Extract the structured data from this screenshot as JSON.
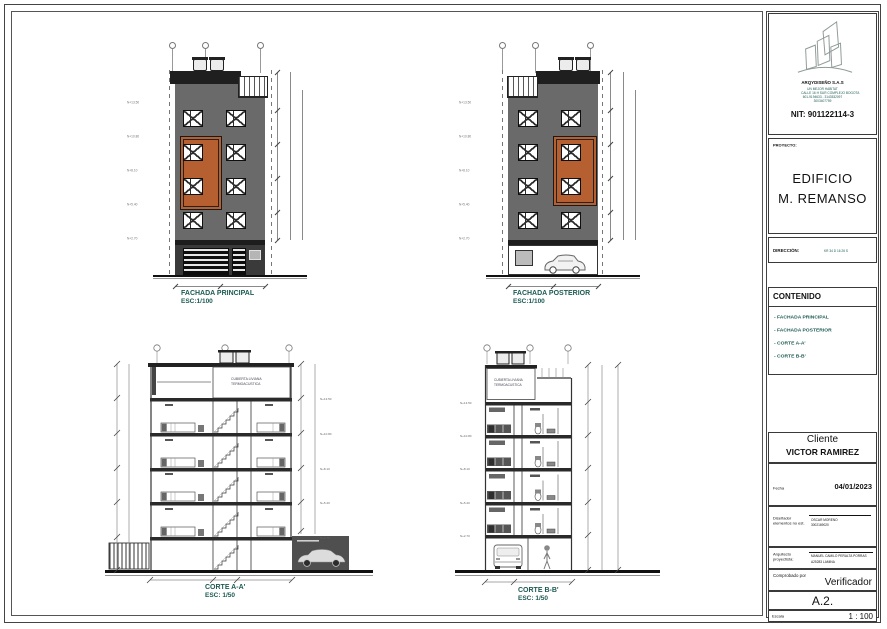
{
  "colors": {
    "facade_gray": "#6a6a6a",
    "facade_dark": "#1f1f1f",
    "accent_orange": "#b65f30",
    "label_teal": "#1c5a52"
  },
  "title_block": {
    "company_name": "ARQYDISEÑO S.A.S",
    "company_line1": "UN MEJOR HABITAT",
    "company_line2": "CALLE 16 H SUR COMPLEJO BOGOTA",
    "company_line3": "601-9194633 - 3143532097",
    "company_line4": "3003407759",
    "nit": "NIT: 901122114-3",
    "proyecto_label": "PROYECTO:",
    "proyecto_line1": "EDIFICIO",
    "proyecto_line2": "M. REMANSO",
    "direccion_label": "DIRECCIÓN:",
    "direccion_value": "KR 34 D 16 26 S",
    "contenido_title": "CONTENIDO",
    "contenido_items": [
      "- FACHADA PRINCIPAL",
      "- FACHADA POSTERIOR",
      "- CORTE A-A'",
      "- CORTE B-B'"
    ],
    "cliente_label": "Cliente",
    "cliente_name": "VICTOR RAMIREZ",
    "fecha_label": "Fecha",
    "fecha_value": "04/01/2023",
    "disenador_label_line1": "Diseñador",
    "disenador_label_line2": "elementos no est.",
    "disenador_value_line1": "OSCAR MORENO",
    "disenador_value_line2": "3002169020",
    "arquitecto_label_line1": "Arquitecto",
    "arquitecto_label_line2": "proyectista:",
    "arquitecto_value_line1": "MANUEL CAMILO PERALTA PORRAS",
    "arquitecto_value_line2": "A25283 LAMINA",
    "comprobado_label": "Comprobado por",
    "comprobado_value": "Verificador",
    "sheet_code": "A.2.",
    "escala_label": "Escala",
    "escala_value": "1 : 100"
  },
  "drawings": {
    "levels": [
      "N+13.50",
      "N+10.80",
      "N+8.10",
      "N+5.40",
      "N+2.70"
    ],
    "fachada_principal": {
      "title": "FACHADA PRINCIPAL",
      "scale": "ESC:1/100"
    },
    "fachada_posterior": {
      "title": "FACHADA POSTERIOR",
      "scale": "ESC:1/100"
    },
    "corte_a": {
      "title": "CORTE A-A'",
      "scale": "ESC: 1/50",
      "roof_note_line1": "CUBIERTA LIVIANA",
      "roof_note_line2": "TERMOACUSTICA"
    },
    "corte_b": {
      "title": "CORTE B-B'",
      "scale": "ESC: 1/50",
      "roof_note_line1": "CUBIERTA LIVIANA",
      "roof_note_line2": "TERMOACUSTICA"
    }
  }
}
